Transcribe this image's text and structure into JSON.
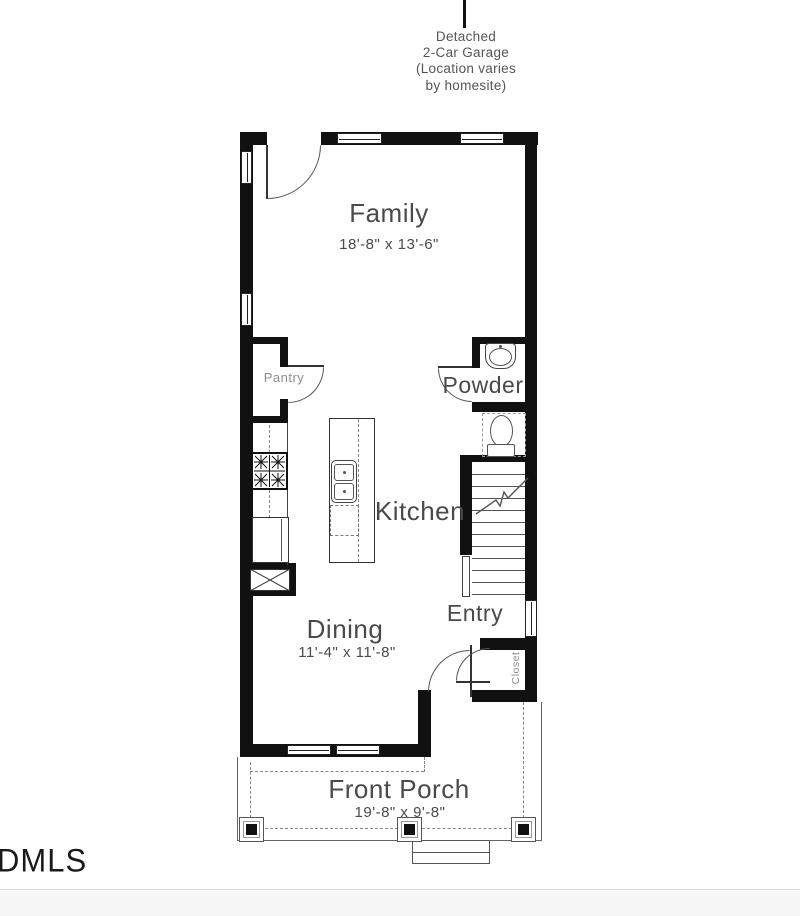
{
  "garage_note": {
    "text": "Detached\n2-Car Garage\n(Location varies\nby homesite)"
  },
  "rooms": {
    "family": {
      "name": "Family",
      "dims": "18'-8\" x 13'-6\""
    },
    "kitchen": {
      "name": "Kitchen"
    },
    "dining": {
      "name": "Dining",
      "dims": "11'-4\" x 11'-8\""
    },
    "entry": {
      "name": "Entry"
    },
    "powder": {
      "name": "Powder"
    },
    "pantry": {
      "name": "Pantry"
    },
    "closet": {
      "name": "Closet"
    },
    "front_porch": {
      "name": "Front Porch",
      "dims": "19'-8\" x 9'-8\""
    }
  },
  "stairs": {
    "tread_count": 11
  },
  "watermark": "DMLS",
  "colors": {
    "wall": "#111111",
    "label": "#4a4a4a",
    "muted_label": "#8c8c8c",
    "line": "#555555"
  }
}
